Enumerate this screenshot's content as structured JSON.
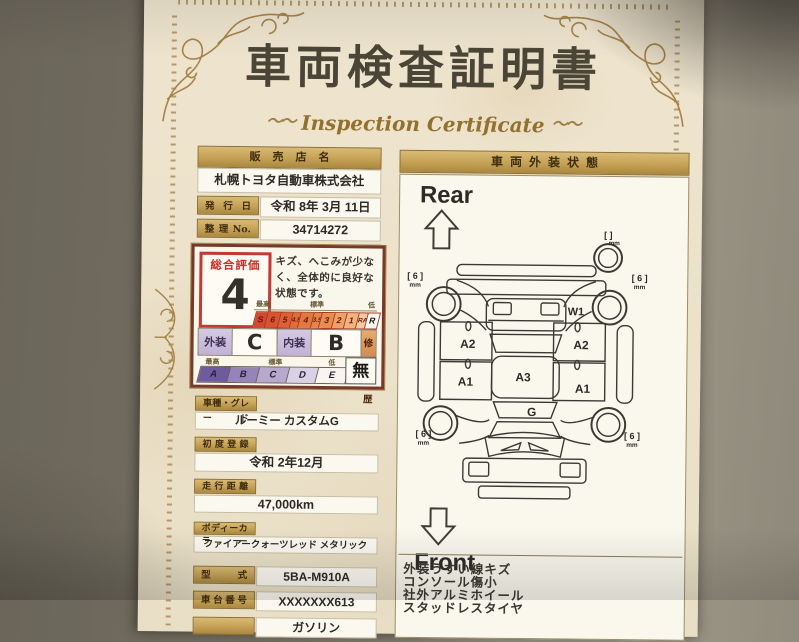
{
  "certificate": {
    "title": "車両検査証明書",
    "subtitle": "Inspection Certificate",
    "flourish": "〜〜"
  },
  "dealer": {
    "header": "販売店名",
    "name": "札幌トヨタ自動車株式会社",
    "issue_label": "発行日",
    "issue_value": "令和  8年  3月 11日",
    "serial_label": "整理No.",
    "serial_value": "34714272"
  },
  "rating": {
    "overall_label": "総合評価",
    "overall_value": "4",
    "comment": "キズ、へこみが少なく、全体的に良好な状態です。",
    "legend_high": "最高",
    "legend_std": "標準",
    "legend_low": "低",
    "scale": [
      "S",
      "6",
      "5",
      "4.5",
      "4",
      "3.5",
      "3",
      "2",
      "1",
      "RA",
      "R"
    ],
    "exterior_label": "外装",
    "exterior_value": "C",
    "interior_label": "内装",
    "interior_value": "B",
    "repair_label": "修復歴",
    "repair_value": "無",
    "letter_scale": [
      "A",
      "B",
      "C",
      "D",
      "E"
    ]
  },
  "fields": [
    {
      "label": "車種・グレード",
      "value": "ルーミー カスタムG"
    },
    {
      "label": "初度登録",
      "value": "令和  2年12月"
    },
    {
      "label": "走行距離",
      "value": "47,000km"
    },
    {
      "label": "ボディーカラー",
      "value": "ファイアークォーツレッド メタリック"
    },
    {
      "label": "型式",
      "value": "5BA-M910A"
    },
    {
      "label": "車台番号",
      "value": "XXXXXXX613"
    },
    {
      "label": "",
      "value": "ガソリン"
    }
  ],
  "exterior_panel": {
    "header": "車両外装状態",
    "rear_label": "Rear",
    "front_label": "Front",
    "diagram": {
      "a1": "A1",
      "a2": "A2",
      "a3": "A3",
      "g": "G",
      "w1": "W1",
      "tread": "[ 6 ]",
      "mm": "mm",
      "spare_bracket": "[    ]"
    },
    "notes": [
      "外装うすい線キズ",
      "コンソール傷小",
      "社外アルミホイール",
      "スタッドレスタイヤ"
    ]
  },
  "colors": {
    "paper": "#ece2ca",
    "gold_accent": "#c6a357",
    "rating_red": "#c23a31",
    "scale_high": "#d4482f",
    "scale_low": "#f7cba2",
    "letter_purple": "#6f5a9c"
  }
}
